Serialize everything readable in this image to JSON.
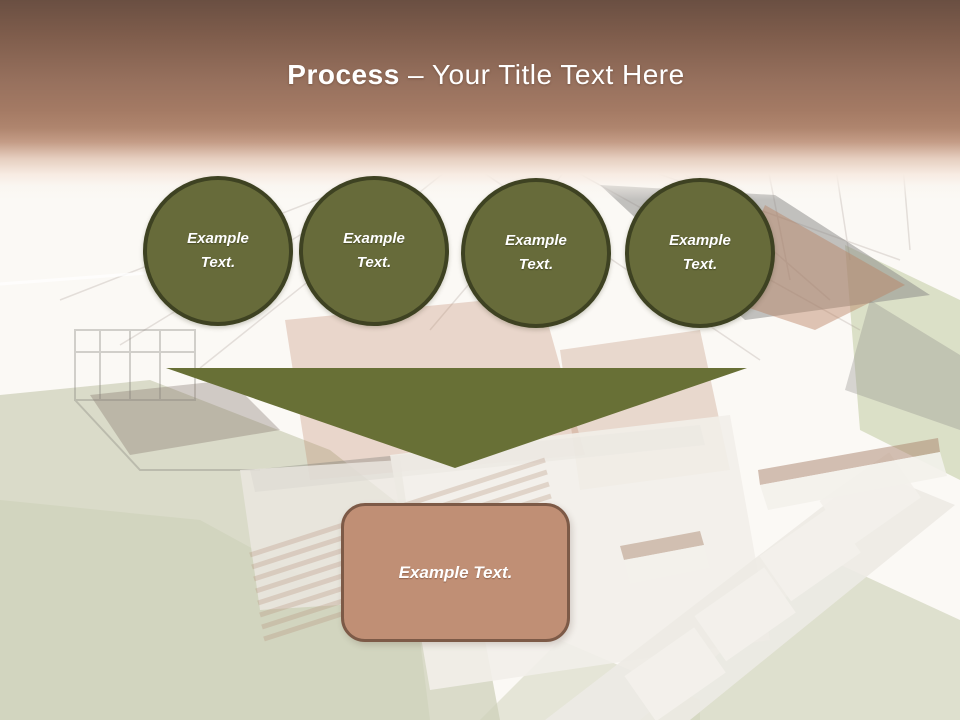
{
  "title": {
    "bold": "Process",
    "rest": " – Your Title Text Here"
  },
  "steps": [
    {
      "label": "Example Text."
    },
    {
      "label": "Example Text."
    },
    {
      "label": "Example Text."
    },
    {
      "label": "Example Text."
    }
  ],
  "callout": {
    "label": "Example Text."
  },
  "background_image": {
    "alt": "Faded 3D render of a house under construction with wireframe roof sketch, brick walls and lawn"
  },
  "colors": {
    "header_top": "#6A4F42",
    "header_mid": "#A47A64",
    "circle_fill": "#676B3A",
    "circle_border": "#3E4222",
    "triangle": "#687036",
    "callout_fill": "#C08F75",
    "callout_border": "#7D5A47",
    "title_text": "#FFFFFF"
  }
}
